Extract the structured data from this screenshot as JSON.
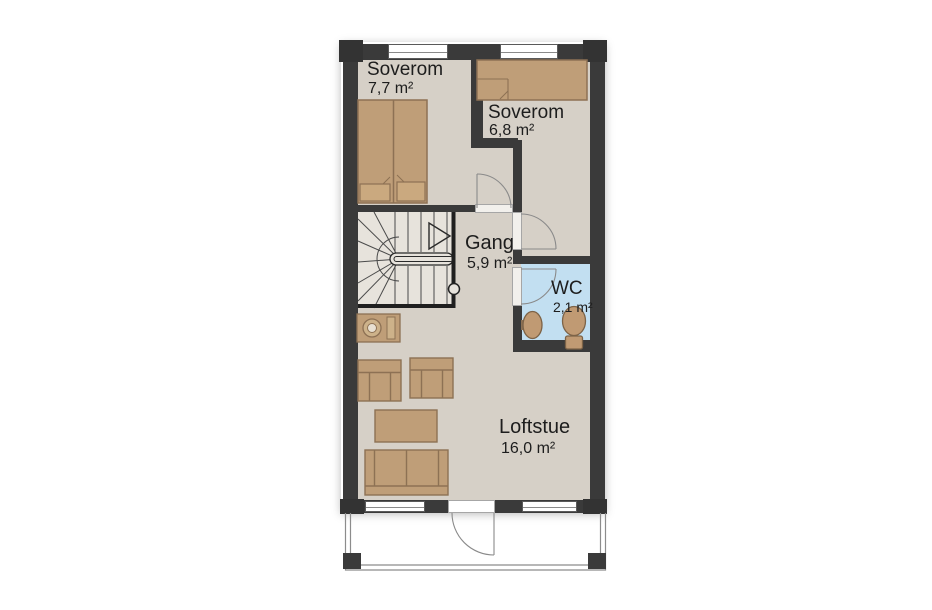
{
  "plan": {
    "type": "floor-plan",
    "rooms": {
      "soverom1": {
        "name": "Soverom",
        "area": "7,7 m²"
      },
      "soverom2": {
        "name": "Soverom",
        "area": "6,8 m²"
      },
      "gang": {
        "name": "Gang",
        "area": "5,9 m²"
      },
      "wc": {
        "name": "WC",
        "area": "2,1 m²"
      },
      "loftstue": {
        "name": "Loftstue",
        "area": "16,0 m²"
      }
    },
    "features": [
      "staircase-with-winders",
      "balcony",
      "double-bed",
      "single-bed",
      "two-armchairs",
      "coffee-table",
      "sofa",
      "toilet",
      "washbasin"
    ],
    "colors": {
      "wall": "#3a3a3a",
      "floor": "#d6d0c7",
      "stair_floor": "#e7e3dc",
      "wc_floor": "#c2dff1",
      "furniture_fill": "#bf9e78",
      "furniture_stroke": "#8d7154",
      "fixture_fill": "#c09a73",
      "door_line": "#8a8a8a",
      "text": "#1d1d1d",
      "background": "#ffffff"
    }
  }
}
